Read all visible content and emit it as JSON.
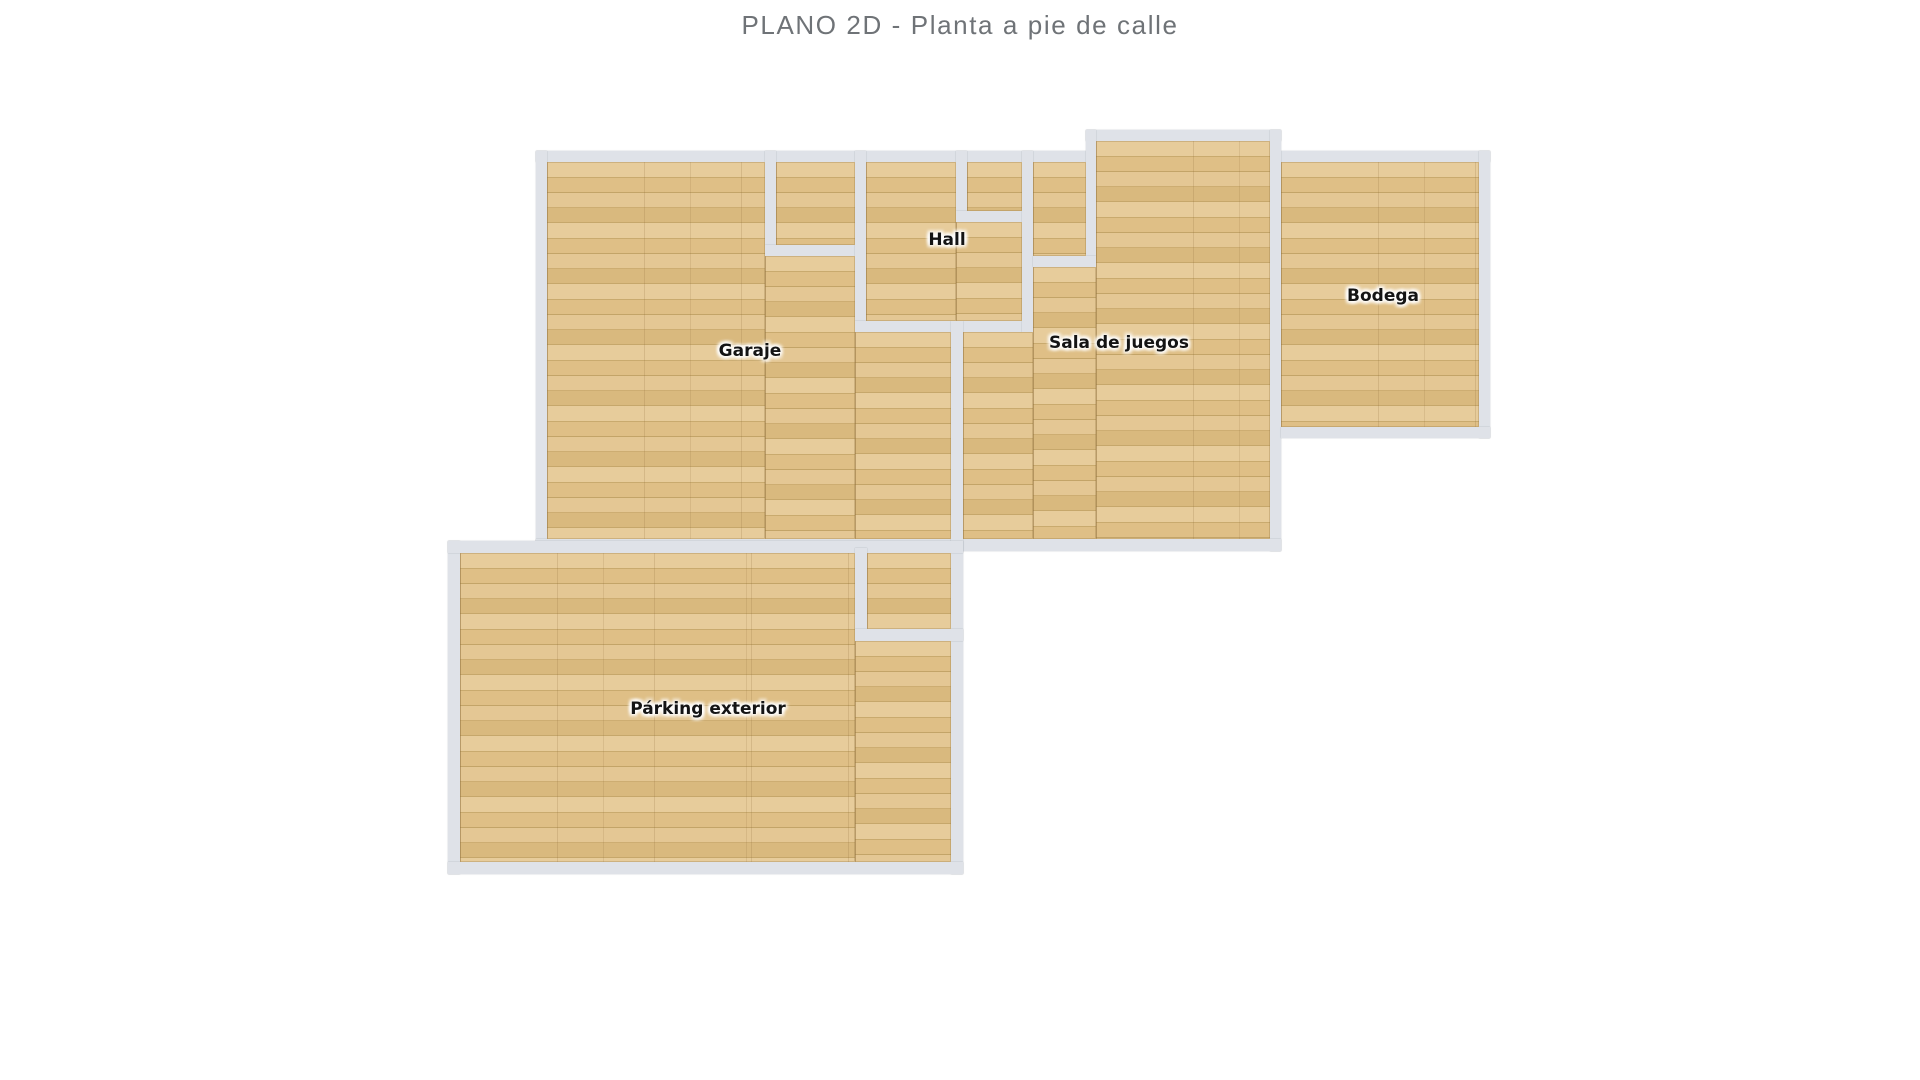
{
  "title": "PLANO 2D - Planta a pie de calle",
  "colors": {
    "background": "#ffffff",
    "wall": "#dfe2e8",
    "floor_base": "#e0c28c",
    "title_text": "#6f7377",
    "label_text": "#141414"
  },
  "plan": {
    "rooms": [
      {
        "id": "garaje",
        "label": "Garaje",
        "label_x": 750,
        "label_y": 351
      },
      {
        "id": "hall",
        "label": "Hall",
        "label_x": 947,
        "label_y": 240
      },
      {
        "id": "sala",
        "label": "Sala de juegos",
        "label_x": 1119,
        "label_y": 343
      },
      {
        "id": "bodega",
        "label": "Bodega",
        "label_x": 1383,
        "label_y": 296
      },
      {
        "id": "parking",
        "label": "Párking exterior",
        "label_x": 708,
        "label_y": 709
      }
    ],
    "floors": [
      {
        "room": "garaje",
        "x": 547,
        "y": 162,
        "w": 218,
        "h": 377
      },
      {
        "room": "garaje",
        "x": 765,
        "y": 256,
        "w": 90,
        "h": 283
      },
      {
        "room": "garaje",
        "x": 855,
        "y": 332,
        "w": 96,
        "h": 207
      },
      {
        "room": "garaje-alcove",
        "x": 776,
        "y": 162,
        "w": 79,
        "h": 83
      },
      {
        "room": "hall",
        "x": 866,
        "y": 162,
        "w": 90,
        "h": 159
      },
      {
        "room": "hall",
        "x": 956,
        "y": 222,
        "w": 66,
        "h": 99
      },
      {
        "room": "hall-nook",
        "x": 967,
        "y": 162,
        "w": 55,
        "h": 49
      },
      {
        "room": "sala-strip",
        "x": 1033,
        "y": 162,
        "w": 53,
        "h": 94
      },
      {
        "room": "sala",
        "x": 1096,
        "y": 141,
        "w": 174,
        "h": 398
      },
      {
        "room": "sala",
        "x": 1033,
        "y": 267,
        "w": 63,
        "h": 272
      },
      {
        "room": "sala",
        "x": 963,
        "y": 332,
        "w": 70,
        "h": 207
      },
      {
        "room": "bodega",
        "x": 1281,
        "y": 162,
        "w": 198,
        "h": 265
      },
      {
        "room": "parking",
        "x": 460,
        "y": 553,
        "w": 395,
        "h": 309
      },
      {
        "room": "parking",
        "x": 855,
        "y": 641,
        "w": 96,
        "h": 221
      },
      {
        "room": "parking-nook",
        "x": 867,
        "y": 553,
        "w": 84,
        "h": 76
      }
    ],
    "walls": [
      {
        "name": "top-wall-main",
        "x": 536,
        "y": 151,
        "w": 550,
        "h": 11
      },
      {
        "name": "top-wall-bodega",
        "x": 1281,
        "y": 151,
        "w": 209,
        "h": 11
      },
      {
        "name": "sala-bump-top-wall",
        "x": 1086,
        "y": 130,
        "w": 195,
        "h": 11
      },
      {
        "name": "sala-bump-left-wall",
        "x": 1086,
        "y": 130,
        "w": 10,
        "h": 137
      },
      {
        "name": "sala-right-wall",
        "x": 1270,
        "y": 130,
        "w": 11,
        "h": 421
      },
      {
        "name": "garaje-left-wall",
        "x": 536,
        "y": 151,
        "w": 11,
        "h": 400
      },
      {
        "name": "south-wall-main",
        "x": 536,
        "y": 539,
        "w": 745,
        "h": 12
      },
      {
        "name": "alcove-left-wall",
        "x": 765,
        "y": 151,
        "w": 11,
        "h": 105
      },
      {
        "name": "alcove-bottom-wall",
        "x": 765,
        "y": 245,
        "w": 101,
        "h": 11
      },
      {
        "name": "hall-left-wall",
        "x": 855,
        "y": 151,
        "w": 11,
        "h": 181
      },
      {
        "name": "hall-bottom-wall",
        "x": 855,
        "y": 321,
        "w": 178,
        "h": 11
      },
      {
        "name": "hall-nook-left-wall",
        "x": 956,
        "y": 151,
        "w": 11,
        "h": 61
      },
      {
        "name": "hall-nook-bottom-wall",
        "x": 956,
        "y": 211,
        "w": 77,
        "h": 11
      },
      {
        "name": "hall-right-wall",
        "x": 1022,
        "y": 151,
        "w": 11,
        "h": 181
      },
      {
        "name": "strip-bottom-wall",
        "x": 1033,
        "y": 256,
        "w": 63,
        "h": 11
      },
      {
        "name": "bodega-right-wall",
        "x": 1479,
        "y": 151,
        "w": 11,
        "h": 287
      },
      {
        "name": "bodega-bottom-wall",
        "x": 1281,
        "y": 427,
        "w": 209,
        "h": 11
      },
      {
        "name": "garaje-sala-divider-wall",
        "x": 951,
        "y": 321,
        "w": 12,
        "h": 553
      },
      {
        "name": "parking-left-wall",
        "x": 448,
        "y": 541,
        "w": 12,
        "h": 333
      },
      {
        "name": "parking-top-wall",
        "x": 448,
        "y": 541,
        "w": 515,
        "h": 12
      },
      {
        "name": "parking-bottom-wall",
        "x": 448,
        "y": 862,
        "w": 515,
        "h": 12
      },
      {
        "name": "parking-nook-left-wall",
        "x": 855,
        "y": 548,
        "w": 12,
        "h": 93
      },
      {
        "name": "parking-nook-bottom-wall",
        "x": 855,
        "y": 629,
        "w": 108,
        "h": 12
      }
    ]
  }
}
